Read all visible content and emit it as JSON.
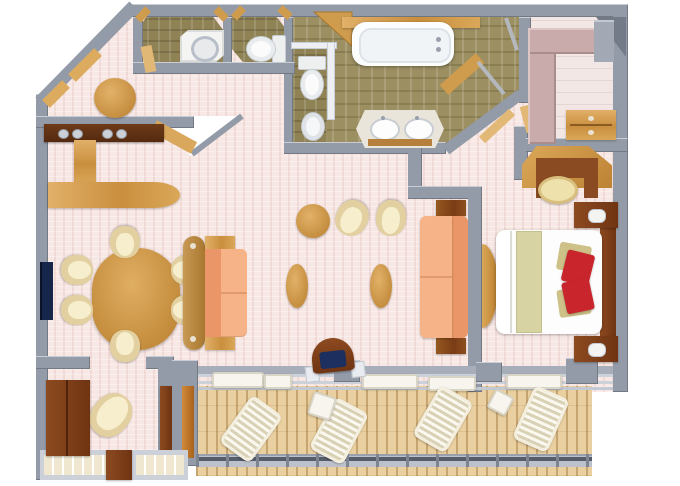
{
  "scene": {
    "type": "floor-plan",
    "subject": "luxury ship suite, 3D top-down render",
    "visible_text": ""
  },
  "palette": {
    "background": "#ffffff",
    "carpet_pink": "#f8e8e5",
    "wall_gray": "#949ba8",
    "wall_white": "#edeff3",
    "tile_olive": "#9c8f62",
    "wood_light": "#d9a85c",
    "wood_dark": "#8a4a22",
    "wood_red": "#7e3b1b",
    "deck_wood": "#ead0a0",
    "sofa_peach": "#f6b387",
    "sofa_peach_dark": "#ea9668",
    "chair_cream": "#e3d0a0",
    "bed_white": "#fdfdfd",
    "bed_khaki": "#d8d3a2",
    "pillow_red": "#c8262c",
    "tv_navy": "#16254a",
    "marble": "#e9e5da",
    "closet_mauve": "#c9abab",
    "rail_gray": "#bcc1cb"
  },
  "rooms": [
    {
      "id": "entrance-hall",
      "label": "Entrance hall"
    },
    {
      "id": "guest-shower-room",
      "label": "Guest shower room"
    },
    {
      "id": "guest-toilet-room",
      "label": "Guest toilet room"
    },
    {
      "id": "master-bathroom",
      "label": "Master bathroom with tub and double vanity"
    },
    {
      "id": "toilet-compartment",
      "label": "Master toilet compartment"
    },
    {
      "id": "walk-in-closet",
      "label": "Walk-in closet"
    },
    {
      "id": "dining-area",
      "label": "Dining area"
    },
    {
      "id": "living-room",
      "label": "Living room"
    },
    {
      "id": "bedroom",
      "label": "Bedroom"
    },
    {
      "id": "sitting-nook",
      "label": "Sitting nook"
    },
    {
      "id": "balcony",
      "label": "Private balcony"
    },
    {
      "id": "hallway",
      "label": "Hallway"
    }
  ],
  "inventory": {
    "living_dining": [
      "wall TV",
      "oval dining table",
      "6 cream dining chairs",
      "wet bar counter with sinks",
      "bar return counter",
      "round hall table",
      "sofa",
      "second sofa",
      "2 oval coffee tables",
      "round table with 2 tub chairs",
      "armchair",
      "desk chair with navy cushion"
    ],
    "bedroom": [
      "king bed with red accent pillows",
      "2 nightstands with lamps",
      "writing desk with stool",
      "curved console"
    ],
    "bathrooms": [
      "bathtub",
      "double vanity",
      "2 toilets",
      "shower tray",
      "glass shower"
    ],
    "closet": [
      "wardrobe unit",
      "dresser",
      "shelving"
    ],
    "balcony": [
      "4 slatted loungers",
      "2 side tables",
      "sliding glass doors",
      "railing"
    ]
  }
}
